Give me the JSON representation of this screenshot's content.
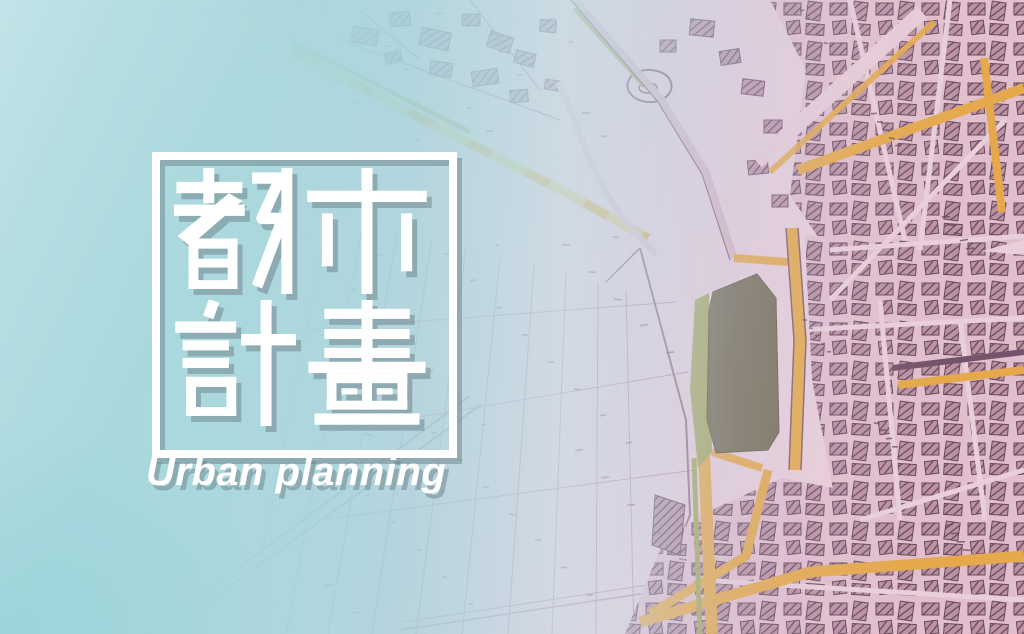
{
  "hero": {
    "title": "都市計畫",
    "title_chars": [
      "都",
      "市",
      "計",
      "畫"
    ],
    "subtitle": "Urban planning"
  },
  "background": {
    "name": "cadastral-map",
    "zones": {
      "left": "solid teal gradient",
      "center": "open farmland parcels with lot numbers",
      "right": "dense urban blocks with hatched buildings"
    }
  },
  "colors": {
    "teal_overlay": "#a8d8dd",
    "map_paper_pink": "#e9cfd9",
    "map_line_rose": "#8a6275",
    "building_hatch": "#5a3f50",
    "road_orange": "#e5a94b",
    "greenbelt_olive": "#a6a75c",
    "parcel_dark_olive": "#6e6549",
    "title_white": "#ffffff",
    "shadow_gray": "#6c8088"
  }
}
